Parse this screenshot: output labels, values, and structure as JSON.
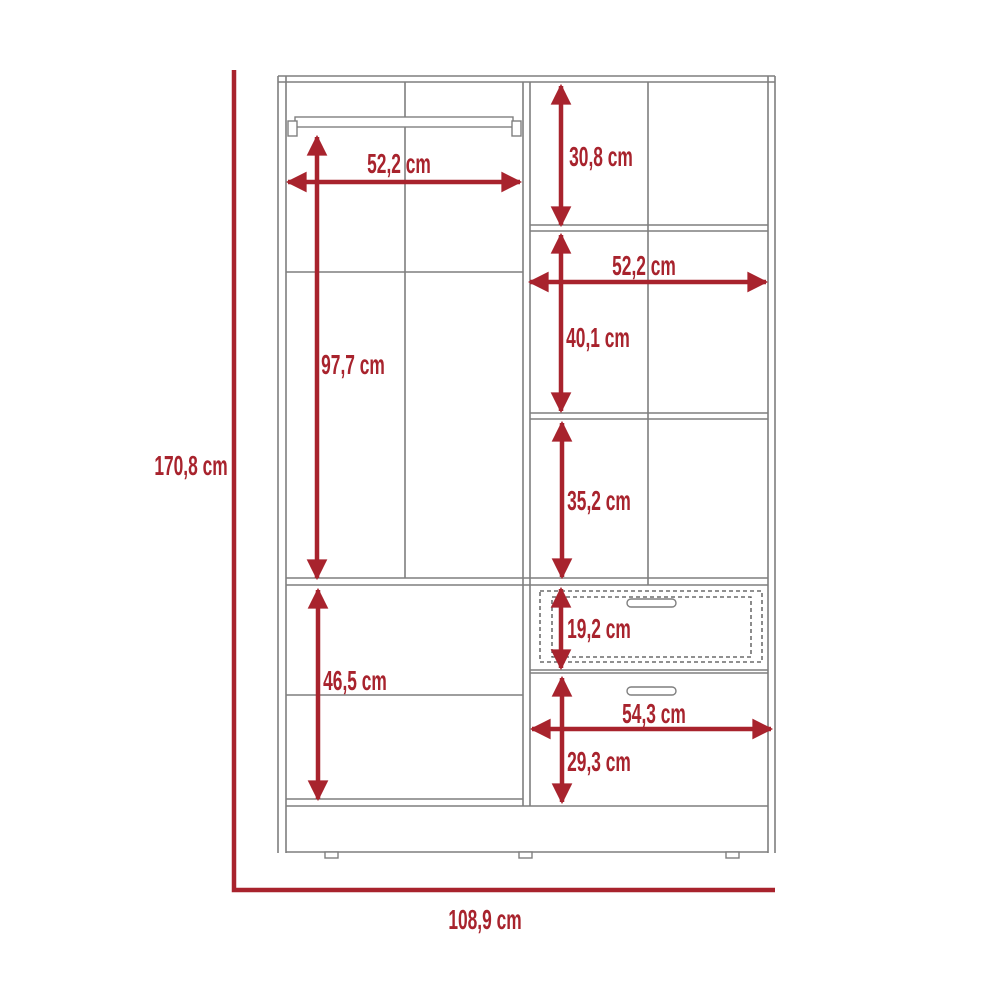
{
  "diagram": {
    "type": "furniture dimension drawing",
    "subject": "wardrobe with shelves and two drawers",
    "unit": "cm"
  },
  "colors": {
    "dimension_red": "#A8232D",
    "outline_gray": "#7F7F7F"
  },
  "dims": {
    "total_height": "170,8 cm",
    "total_width": "108,9 cm",
    "left_section_width": "52,2 cm",
    "hanging_space_height": "97,7 cm",
    "lower_left_section_height": "46,5 cm",
    "top_right_shelf_height": "30,8 cm",
    "right_section_width": "52,2 cm",
    "middle_right_shelf_height": "40,1 cm",
    "lower_right_shelf_height": "35,2 cm",
    "top_drawer_height": "19,2 cm",
    "drawer_width": "54,3 cm",
    "bottom_drawer_height": "29,3 cm"
  }
}
